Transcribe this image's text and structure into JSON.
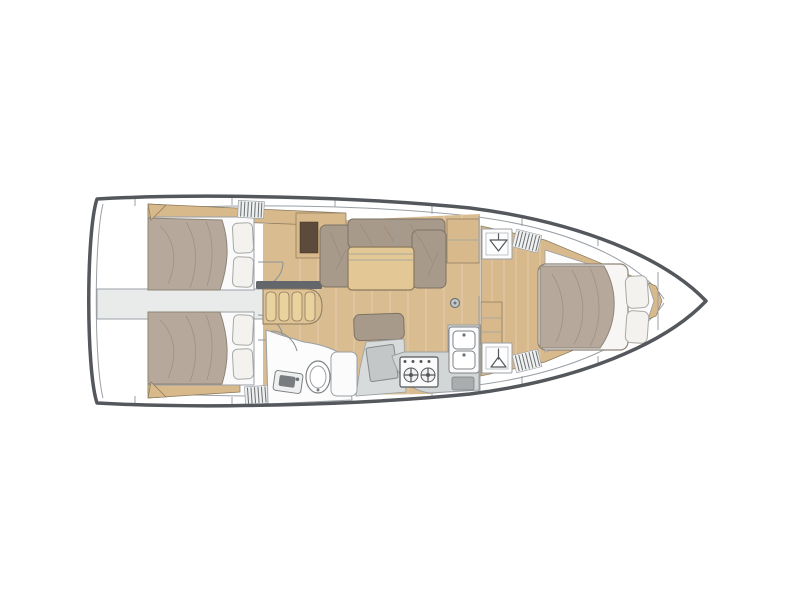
{
  "figure": {
    "type": "yacht-interior-floor-plan",
    "orientation": "bow-right",
    "decks": 1
  },
  "palette": {
    "hull_stroke": "#54585c",
    "line": "#9aa0a4",
    "wood_trim": "#d8b98b",
    "wood_floor": "#d9bc90",
    "wood_table": "#e3c795",
    "wood_steps": "#e0c394",
    "wood_edge": "#8a7a5e",
    "cushion": "#a89a8b",
    "cushion_edge": "#7d7265",
    "duvet": "#b6a89a",
    "duvet_edge": "#8d8478",
    "pillow": "#f4f2ee",
    "gray_panel": "#e9ebeb",
    "counter_gray": "#d3d6d6",
    "chart_gray": "#c3c7c8",
    "dark_bar": "#63676b",
    "cabinet_opening": "#5c4a3a",
    "fixture_stroke": "#7d8184",
    "white_soft": "#fbfbfb"
  },
  "icons": {
    "hanging_locker": "hanger-glyph",
    "wet_locker": "stem-and-triangle-glyph",
    "stove": "two-burner-rings",
    "sink": "double-basin",
    "toilet": "oval-bowl",
    "mast_foot": "circle-with-dot",
    "louver_vent": "hatched-lines",
    "companionway": "four-wood-steps"
  }
}
